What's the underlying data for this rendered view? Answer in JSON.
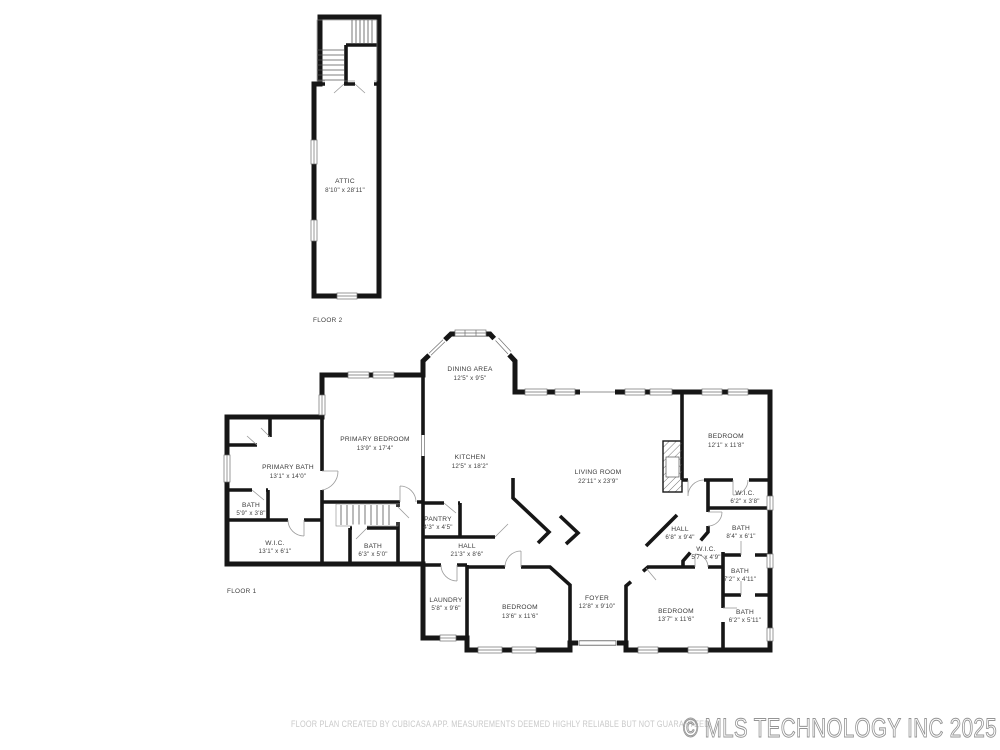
{
  "floor2": {
    "label": "FLOOR 2",
    "rooms": [
      {
        "name": "ATTIC",
        "dims": "8'10\" x 28'11\""
      }
    ]
  },
  "floor1": {
    "label": "FLOOR 1",
    "rooms": [
      {
        "name": "PRIMARY BEDROOM",
        "dims": "13'9\" x 17'4\""
      },
      {
        "name": "PRIMARY BATH",
        "dims": "13'1\" x 14'0\""
      },
      {
        "name": "BATH",
        "dims": "5'9\" x 3'8\""
      },
      {
        "name": "W.I.C.",
        "dims": "13'1\" x 6'1\""
      },
      {
        "name": "BATH",
        "dims": "6'3\" x 5'0\""
      },
      {
        "name": "DINING AREA",
        "dims": "12'5\" x 9'5\""
      },
      {
        "name": "KITCHEN",
        "dims": "12'5\" x 18'2\""
      },
      {
        "name": "PANTRY",
        "dims": "4'3\" x 4'5\""
      },
      {
        "name": "HALL",
        "dims": "21'3\" x 8'6\""
      },
      {
        "name": "LIVING ROOM",
        "dims": "22'11\" x 23'9\""
      },
      {
        "name": "LAUNDRY",
        "dims": "5'8\" x 9'6\""
      },
      {
        "name": "BEDROOM",
        "dims": "13'6\" x 11'6\""
      },
      {
        "name": "FOYER",
        "dims": "12'8\" x 9'10\""
      },
      {
        "name": "BEDROOM",
        "dims": "13'7\" x 11'6\""
      },
      {
        "name": "BEDROOM",
        "dims": "12'1\" x 11'8\""
      },
      {
        "name": "W.I.C.",
        "dims": "6'2\" x 3'8\""
      },
      {
        "name": "BATH",
        "dims": "8'4\" x 6'1\""
      },
      {
        "name": "HALL",
        "dims": "6'8\" x 9'4\""
      },
      {
        "name": "W.I.C.",
        "dims": "5'7\" x 4'9\""
      },
      {
        "name": "BATH",
        "dims": "7'2\" x 4'11\""
      },
      {
        "name": "BATH",
        "dims": "6'2\" x 5'11\""
      }
    ]
  },
  "footer": {
    "disclaimer": "FLOOR PLAN CREATED BY CUBICASA APP. MEASUREMENTS DEEMED HIGHLY RELIABLE BUT NOT GUARANTEED."
  },
  "watermark": {
    "text": "© MLS TECHNOLOGY INC 2025"
  },
  "colors": {
    "wall": "#161616",
    "room_label": "#3a3a3a",
    "disclaimer": "#c9c9c9",
    "watermark": "#949494",
    "background": "#ffffff"
  }
}
